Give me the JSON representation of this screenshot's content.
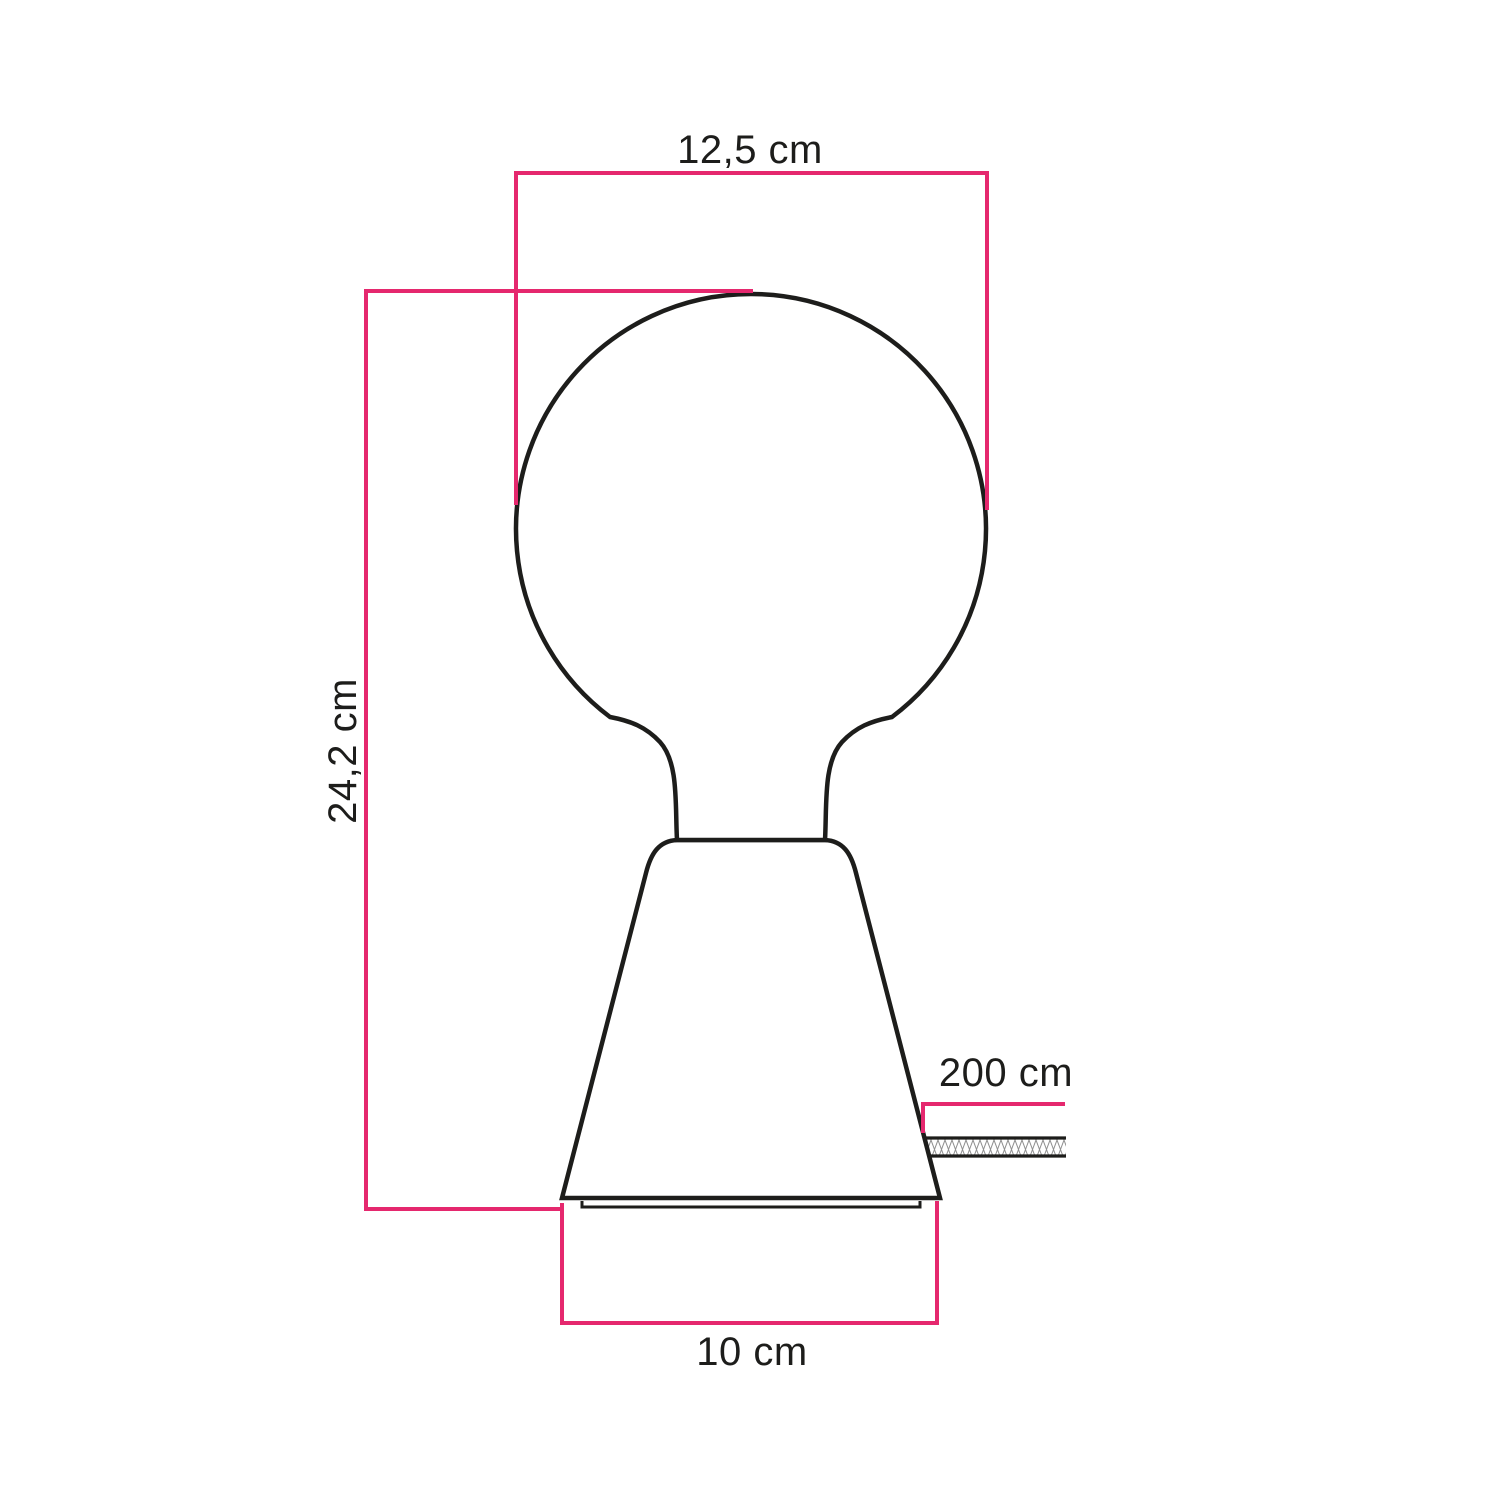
{
  "diagram": {
    "dimensions": {
      "bulb_diameter_label": "12,5 cm",
      "total_height_label": "24,2 cm",
      "cable_length_label": "200 cm",
      "base_diameter_label": "10 cm"
    },
    "colors": {
      "dimension_pink": "#e5286e",
      "outline_black": "#1d1d1b",
      "hatch_gray": "#8f8f8f",
      "background": "#ffffff"
    }
  }
}
